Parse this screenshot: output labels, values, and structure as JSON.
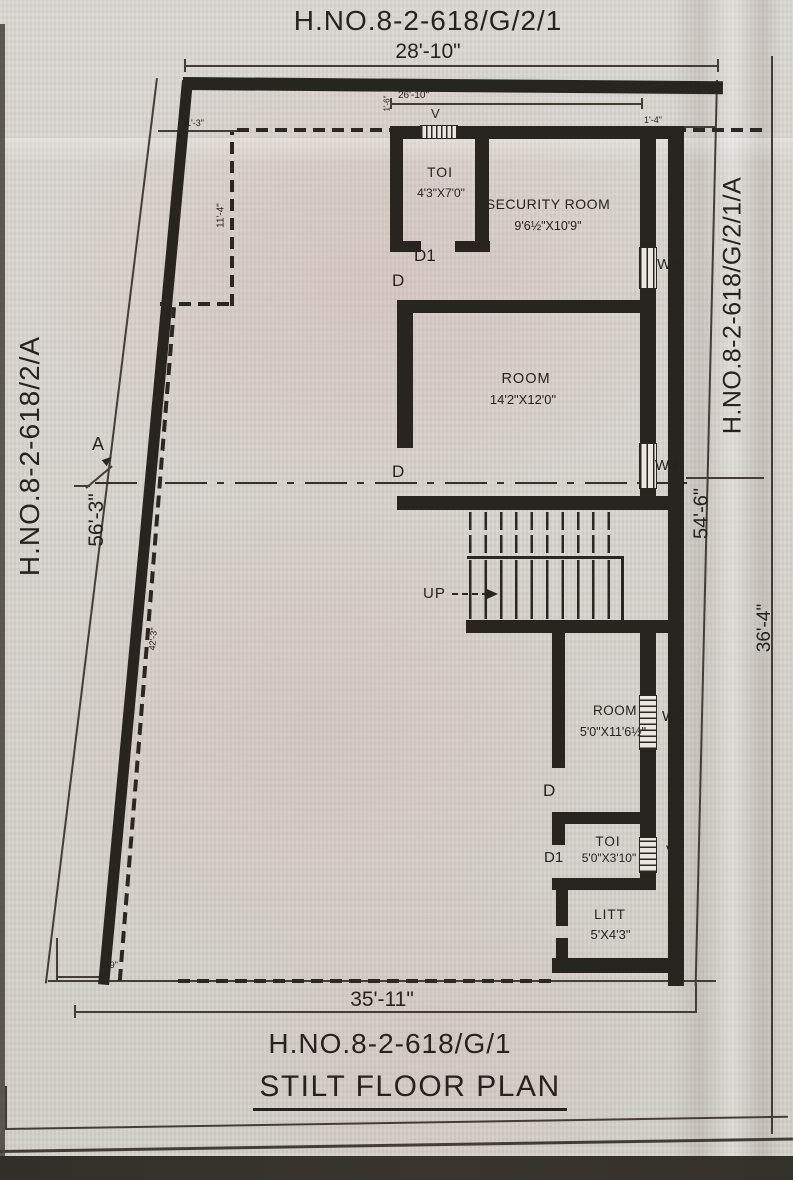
{
  "colors": {
    "paper": "#d8d4cf",
    "ink": "#2a2621",
    "pink_tint": "#c58e85"
  },
  "header": {
    "house_no": "H.NO.8-2-618/G/2/1"
  },
  "footer": {
    "house_no": "H.NO.8-2-618/G/1",
    "title": "STILT FLOOR PLAN"
  },
  "boundaries": {
    "left_house_no": "H.NO.8-2-618/2/A",
    "right_house_no": "H.NO.8-2-618/G/2/1/A"
  },
  "dimensions": {
    "top": "28'-10\"",
    "top_inner": "26'-10\"",
    "bottom": "35'-11\"",
    "left": "56'-3\"",
    "right_upper": "54'-6\"",
    "right_lower": "36'-4\"",
    "offset_left_small": "1'-3\"",
    "offset_top_left": "1'-6\"",
    "offset_top_right": "1'-4\"",
    "column_recess": "11'-4\"",
    "slant": "42'-3\"",
    "notch": "5'-9\""
  },
  "rooms": {
    "toi_upper": {
      "name": "TOI",
      "size": "4'3\"X7'0\""
    },
    "security_room": {
      "name": "SECURITY ROOM",
      "size": "9'6½\"X10'9\""
    },
    "room_large": {
      "name": "ROOM",
      "size": "14'2\"X12'0\""
    },
    "room_small": {
      "name": "ROOM",
      "size": "5'0\"X11'6½\""
    },
    "toi_lower": {
      "name": "TOI",
      "size": "5'0\"X3'10\""
    },
    "litt": {
      "name": "LITT",
      "size": "5'X4'3\""
    }
  },
  "markers": {
    "up": "UP",
    "door": "D",
    "door_1": "D1",
    "window_3": "W3",
    "vent": "V",
    "section": "A"
  }
}
